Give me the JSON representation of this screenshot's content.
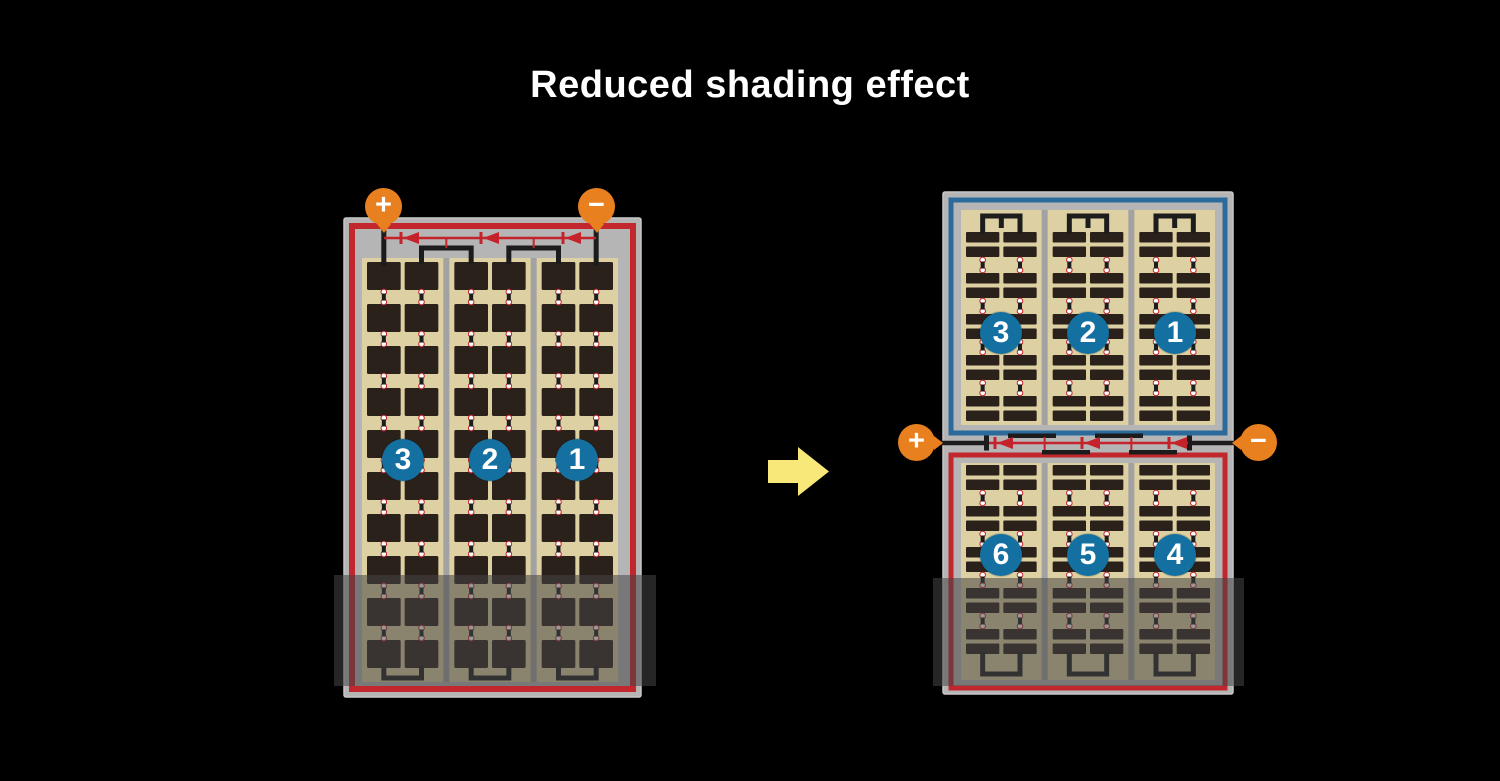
{
  "title": "Reduced shading effect",
  "before_panel": {
    "terminal_positive": "+",
    "terminal_negative": "−",
    "string_labels": [
      "3",
      "2",
      "1"
    ]
  },
  "after_panel": {
    "terminal_positive": "+",
    "terminal_negative": "−",
    "top_string_labels": [
      "3",
      "2",
      "1"
    ],
    "bottom_string_labels": [
      "6",
      "5",
      "4"
    ]
  },
  "colors": {
    "background": "#000000",
    "title_text": "#ffffff",
    "frame_gray": "#b5b5b5",
    "frame_edge": "#c7c7c7",
    "cell_area_tan": "#ddd0a2",
    "cell_dark": "#2b211b",
    "separator_gray": "#a2a2a2",
    "string_border_red": "#c1272d",
    "string_border_blue": "#2b6a9b",
    "diode_red": "#c5232b",
    "wire_black": "#1c1c1c",
    "number_circle_blue": "#1470a0",
    "number_text": "#ffffff",
    "terminal_orange": "#e8801f",
    "terminal_text": "#ffffff",
    "arrow_yellow": "#f8e87a",
    "dot_white": "#ffffff",
    "shading_overlay": "rgba(70,70,70,0.55)"
  }
}
